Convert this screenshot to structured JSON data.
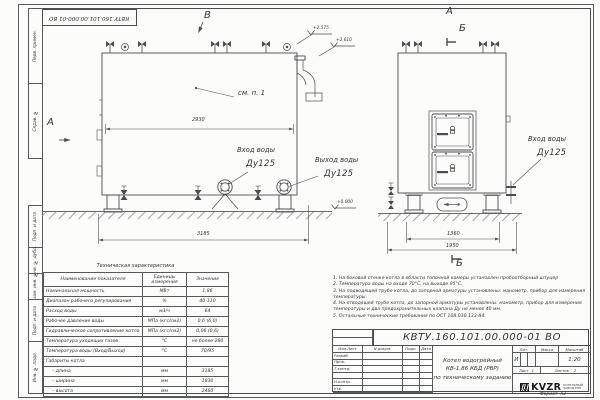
{
  "frame": {
    "stamp_code": "КВТУ.160.101.00.000-01 ВО",
    "left_labels_top": [
      "Перв. примен.",
      "Справ. №"
    ],
    "left_labels_bottom": [
      "Подп. и дата",
      "Инв. № дубл.",
      "Взам. инв. №",
      "Подп. и дата",
      "Инв. № подл."
    ],
    "format_label": "Формат",
    "format_value": "А3"
  },
  "drawing": {
    "view_b_label": "В",
    "view_a_label": "А",
    "front_view_label": "А",
    "section_label_top": "Б",
    "section_label_bottom": "Б",
    "note_ref": "см. п. 1",
    "dims": {
      "body_length": "2930",
      "overall_length": "3185",
      "support_span": "1360",
      "base_width": "1950"
    },
    "elevations": {
      "top1": "+2.575",
      "top2": "+2.610",
      "zero": "+0.000"
    },
    "water_inlet_label": "Вход воды",
    "water_inlet_dn": "Ду125",
    "water_outlet_label": "Выход воды",
    "water_outlet_dn": "Ду125",
    "front_inlet_label": "Вход воды",
    "front_inlet_dn": "Ду125"
  },
  "spec_table": {
    "title": "Техническая характеристика",
    "headers": [
      "Наименование показателя",
      "Единицы измерения",
      "Значение"
    ],
    "rows": [
      [
        "Номинальная мощность",
        "МВт",
        "1,86"
      ],
      [
        "Диапазон рабочего регулирования",
        "%",
        "40-110"
      ],
      [
        "Расход воды",
        "м3/ч",
        "64"
      ],
      [
        "Рабочее давление воды",
        "МПа (кгс/см2)",
        "0,6 (6,0)"
      ],
      [
        "Гидравлическое сопротивление котла",
        "МПа (кгс/см2)",
        "0,06 (0,6)"
      ],
      [
        "Температура уходящих газов",
        "°С",
        "не более 280"
      ],
      [
        "Температура воды (Вход/Выход)",
        "°С",
        "70/95"
      ],
      [
        "Габариты котла",
        "",
        ""
      ],
      [
        "– длина",
        "мм",
        "3185"
      ],
      [
        "– ширина",
        "мм",
        "1830"
      ],
      [
        "– высота",
        "мм",
        "2460"
      ]
    ]
  },
  "notes": [
    "1. На боковой стенке котла в области топочной камеры установлен пробоотборный штуцер",
    "2. Температура воды на входе 70°С, на выходе 95°С.",
    "3. На подводящей трубе котла, до запорной арматуры установлены: манометр, прибор для измерения температуры.",
    "4. На отводящей трубе котла, до запорной арматуры установлены: манометр, прибор для измерения температуры и два предохранительных клапана Ду не менее 40 мм.",
    "5. Остальные технические требования по ОСТ 108.030.133-84."
  ],
  "title_block": {
    "designation": "КВТУ.160.101.00.000-01 ВО",
    "name_line1": "Котел водогрейный",
    "name_line2": "КВ-1,86 КБД (РВР)",
    "name_line3": "по техническому заданию",
    "cols": [
      "Изм.Лист",
      "N докум.",
      "Подп.",
      "Дата"
    ],
    "roles": [
      "Разраб.",
      "Пров.",
      "Т.контр.",
      "",
      "Н.контр.",
      "Утв."
    ],
    "lit_label": "Лит.",
    "lit_value": "И",
    "mass_label": "Масса",
    "scale_label": "Масштаб",
    "scale_value": "1:20",
    "sheet_label": "Лист",
    "sheet_value": "1",
    "sheets_label": "Листов",
    "sheets_value": "2",
    "brand": "KVZR",
    "brand_line1": "КОТЕЛЬНЫЙ",
    "brand_line2": "ЗАВОД РЭП"
  }
}
